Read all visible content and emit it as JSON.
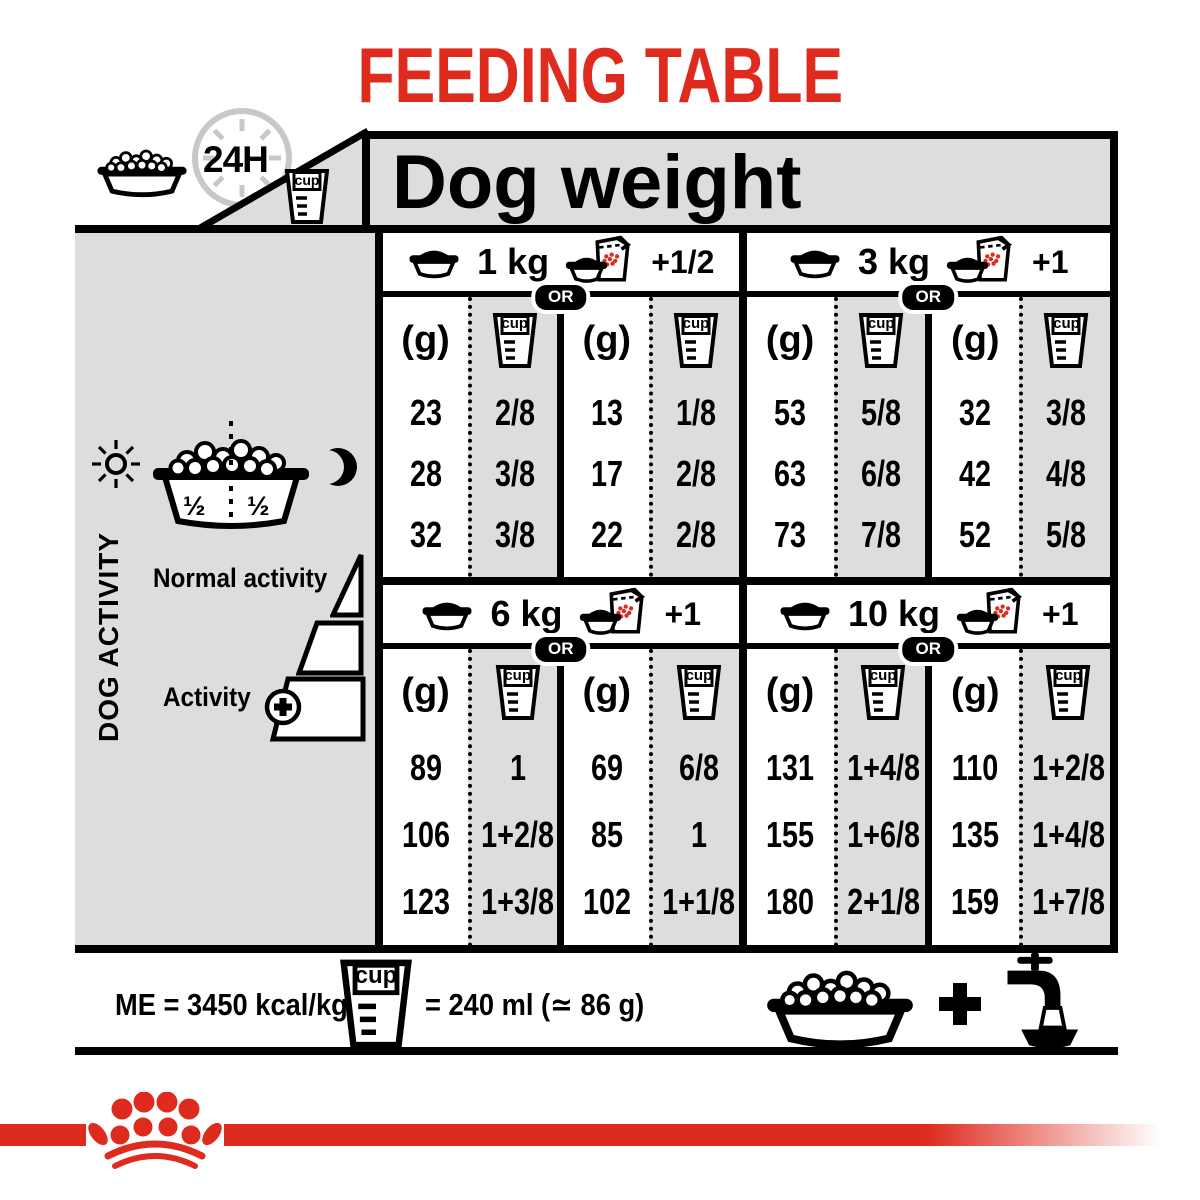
{
  "colors": {
    "red": "#df2b1e",
    "gray": "#dcdedd",
    "black": "#000000"
  },
  "title": "FEEDING TABLE",
  "header": {
    "clock": "24H",
    "cup": "cup",
    "dog_weight": "Dog weight"
  },
  "labels": {
    "g": "(g)",
    "cup": "cup",
    "or": "OR"
  },
  "sidebar": {
    "dog_activity": "DOG ACTIVITY",
    "half_left": "½",
    "half_right": "½",
    "normal_activity": "Normal activity",
    "activity": "Activity"
  },
  "sections": [
    {
      "weight": "1 kg",
      "extra": "+1/2",
      "dry": {
        "g": [
          "23",
          "28",
          "32"
        ],
        "cup": [
          "2/8",
          "3/8",
          "3/8"
        ]
      },
      "mix": {
        "g": [
          "13",
          "17",
          "22"
        ],
        "cup": [
          "1/8",
          "2/8",
          "2/8"
        ]
      }
    },
    {
      "weight": "3 kg",
      "extra": "+1",
      "dry": {
        "g": [
          "53",
          "63",
          "73"
        ],
        "cup": [
          "5/8",
          "6/8",
          "7/8"
        ]
      },
      "mix": {
        "g": [
          "32",
          "42",
          "52"
        ],
        "cup": [
          "3/8",
          "4/8",
          "5/8"
        ]
      }
    },
    {
      "weight": "6 kg",
      "extra": "+1",
      "dry": {
        "g": [
          "89",
          "106",
          "123"
        ],
        "cup": [
          "1",
          "1+2/8",
          "1+3/8"
        ]
      },
      "mix": {
        "g": [
          "69",
          "85",
          "102"
        ],
        "cup": [
          "6/8",
          "1",
          "1+1/8"
        ]
      }
    },
    {
      "weight": "10 kg",
      "extra": "+1",
      "dry": {
        "g": [
          "131",
          "155",
          "180"
        ],
        "cup": [
          "1+4/8",
          "1+6/8",
          "2+1/8"
        ]
      },
      "mix": {
        "g": [
          "110",
          "135",
          "159"
        ],
        "cup": [
          "1+2/8",
          "1+4/8",
          "1+7/8"
        ]
      }
    }
  ],
  "footer": {
    "me": "ME = 3450 kcal/kg",
    "cup": "cup",
    "equiv": "= 240 ml (≃ 86 g)"
  }
}
